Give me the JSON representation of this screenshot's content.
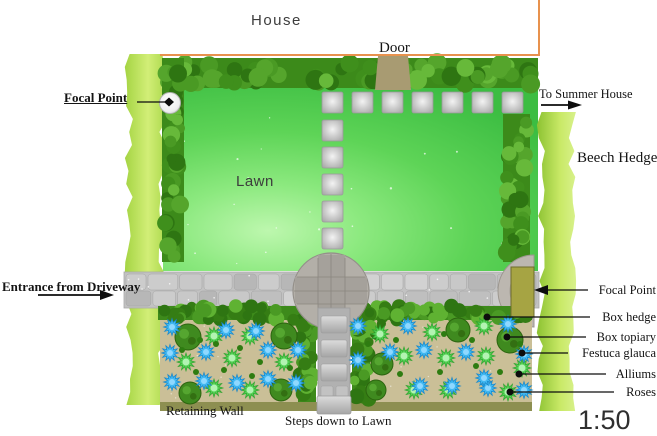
{
  "plan_labels": {
    "house": "House",
    "door": "Door",
    "lawn": "Lawn",
    "focal_point": "Focal Point",
    "to_summer_house": "To Summer House",
    "beech_hedge": "Beech Hedge",
    "entrance": "Entrance from Driveway",
    "retaining_wall": "Retaining Wall",
    "steps": "Steps down to Lawn",
    "scale": "1:50"
  },
  "legend": {
    "items": [
      {
        "label": "Focal Point"
      },
      {
        "label": "Box hedge"
      },
      {
        "label": "Box topiary"
      },
      {
        "label": "Festuca glauca"
      },
      {
        "label": "Alliums"
      },
      {
        "label": "Roses"
      }
    ]
  },
  "colors": {
    "house_outline": "#e8924e",
    "lawn_green": "#5ed457",
    "dark_hedge": "#3f8f1c",
    "beech_hedge_light": "#cdeb6e",
    "soil": "#cabf97",
    "paving": "#c2c2c2",
    "retaining_wall": "#8d8f51",
    "focal_structure": "#a6a443",
    "door": "#a89b72",
    "festuca_blue": "#41b8f1",
    "plant_green": "#54cf54",
    "box_green": "#3f8a1f"
  }
}
